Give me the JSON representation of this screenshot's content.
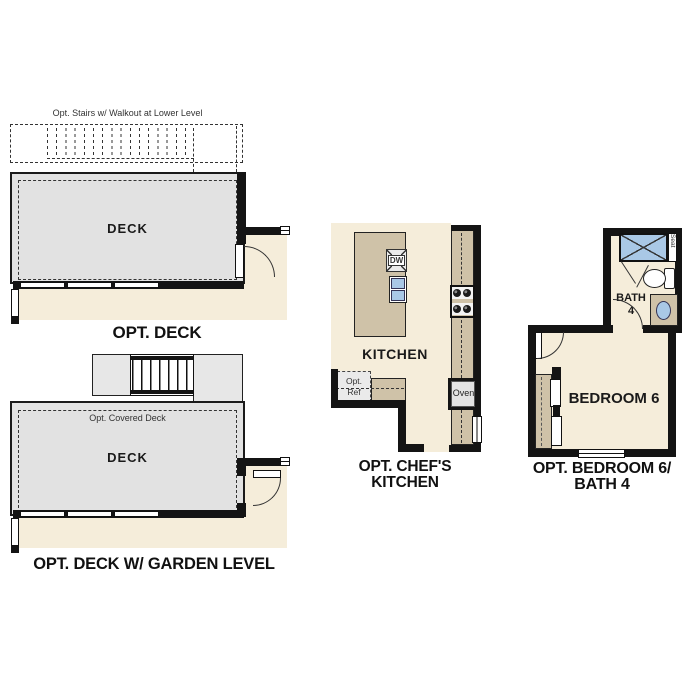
{
  "colors": {
    "beige": "#f5edda",
    "deck": "#e2e2e2",
    "stair": "#e7e7e7",
    "tan": "#cfc2a8",
    "appliance": "#eaeaea",
    "blue": "#a9c8e6",
    "wall": "#141414",
    "text": "#111111"
  },
  "plans": {
    "opt_deck": {
      "title": "OPT. DECK",
      "room_label": "DECK",
      "stairs_note": "Opt. Stairs w/ Walkout at Lower Level"
    },
    "opt_deck_garden": {
      "title": "OPT. DECK W/ GARDEN LEVEL",
      "room_label": "DECK",
      "covered_note": "Opt. Covered Deck"
    },
    "opt_chefs_kitchen": {
      "title_line1": "OPT. CHEF'S",
      "title_line2": "KITCHEN",
      "room_label": "KITCHEN",
      "dishwasher_label": "DW",
      "oven_label": "Oven",
      "ref_line1": "Opt.",
      "ref_line2": "Ref"
    },
    "opt_bedroom6_bath4": {
      "title_line1": "OPT. BEDROOM 6/",
      "title_line2": "BATH 4",
      "bedroom_label": "BEDROOM 6",
      "bath_line1": "BATH",
      "bath_line2": "4",
      "seat_label": "Seat"
    }
  }
}
